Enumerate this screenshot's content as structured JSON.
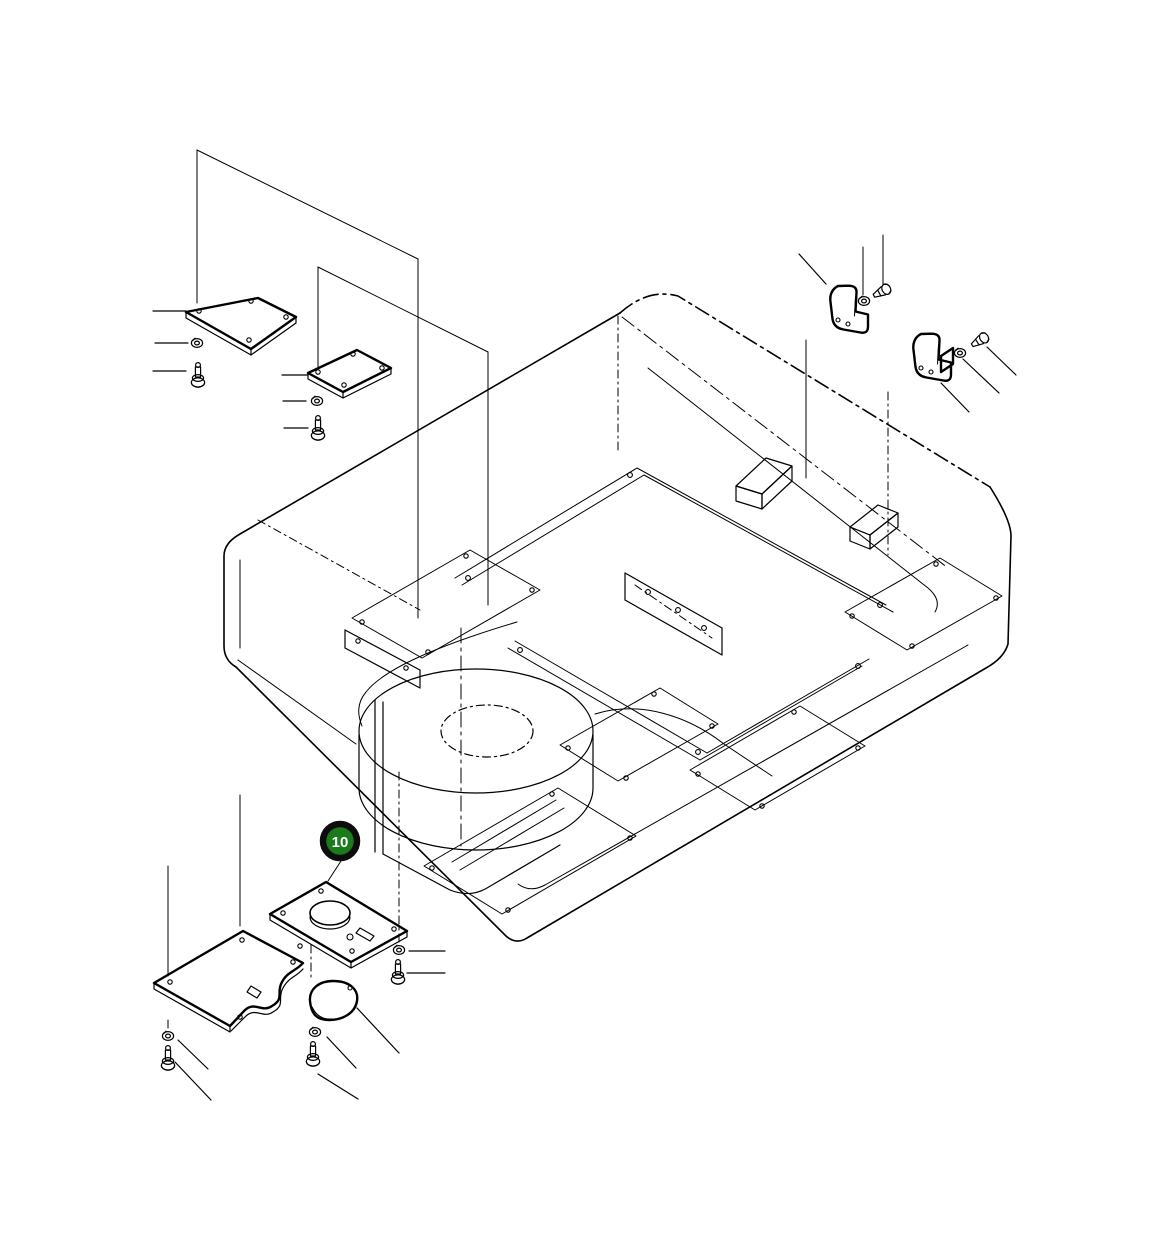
{
  "diagram": {
    "background": "#ffffff",
    "ink": "#000000",
    "callout": {
      "label": "10",
      "fill": "#1b7a1b",
      "ring": "#0d0d0d",
      "text_color": "#ffffff"
    }
  }
}
